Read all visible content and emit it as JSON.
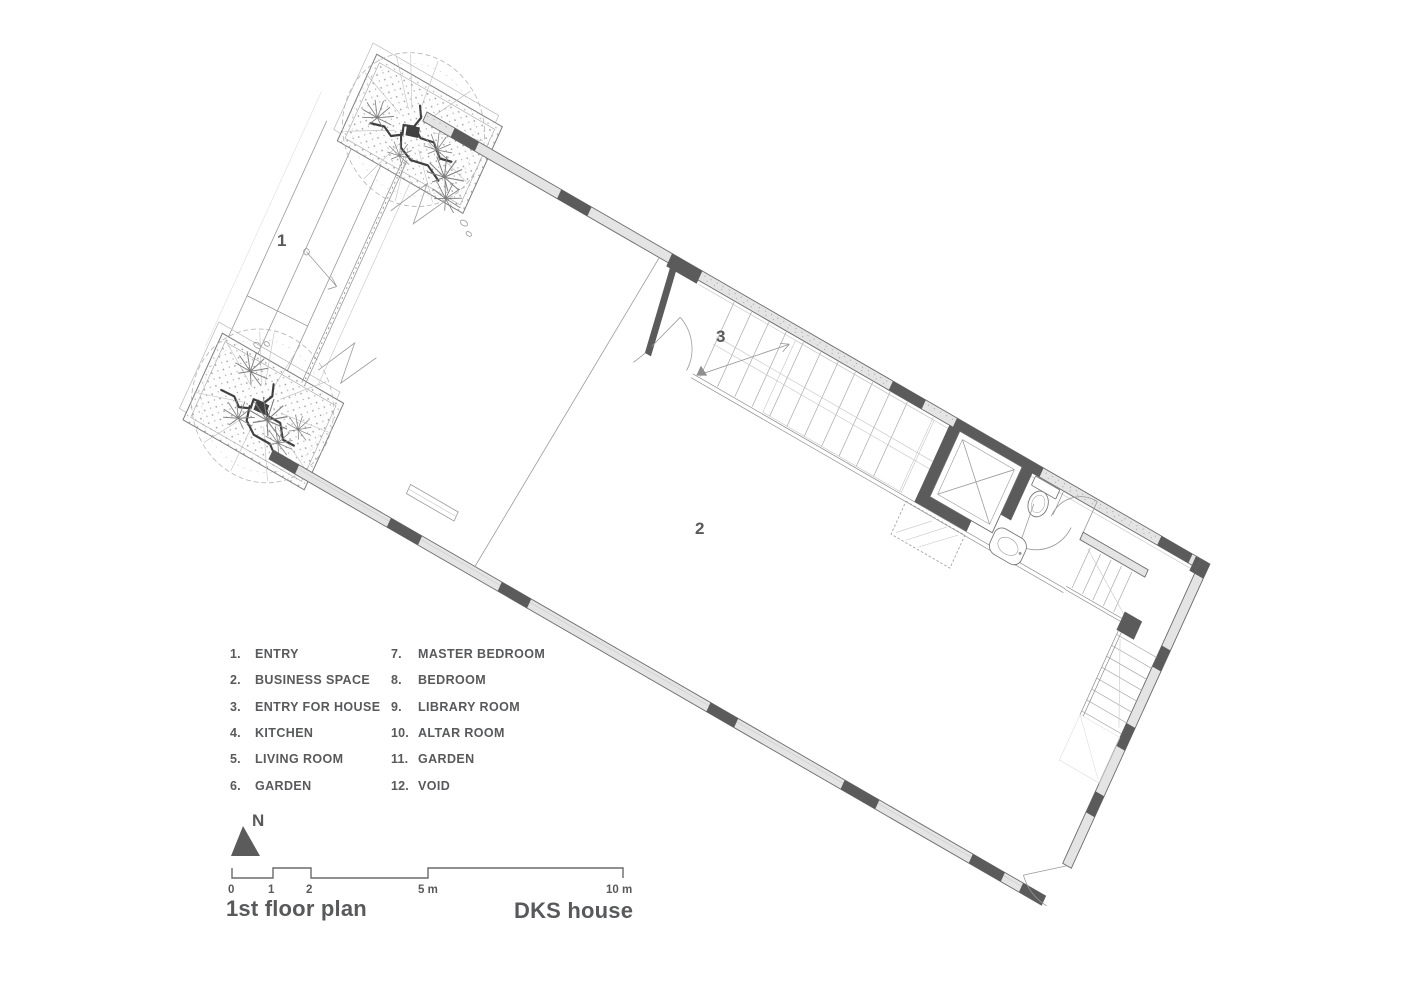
{
  "titles": {
    "plan_title": "1st floor plan",
    "project_title": "DKS house"
  },
  "compass": {
    "label": "N"
  },
  "scale_bar": {
    "labels": [
      "0",
      "1",
      "2",
      "5 m",
      "10 m"
    ]
  },
  "plan": {
    "room_markers": [
      "1",
      "2",
      "3"
    ]
  },
  "legend": {
    "col1": [
      {
        "n": "1.",
        "label": "ENTRY"
      },
      {
        "n": "2.",
        "label": "BUSINESS SPACE"
      },
      {
        "n": "3.",
        "label": "ENTRY FOR HOUSE"
      },
      {
        "n": "4.",
        "label": "KITCHEN"
      },
      {
        "n": "5.",
        "label": "LIVING ROOM"
      },
      {
        "n": "6.",
        "label": "GARDEN"
      }
    ],
    "col2": [
      {
        "n": "7.",
        "label": "MASTER BEDROOM"
      },
      {
        "n": "8.",
        "label": "BEDROOM"
      },
      {
        "n": "9.",
        "label": "LIBRARY ROOM"
      },
      {
        "n": "10.",
        "label": "ALTAR ROOM"
      },
      {
        "n": "11.",
        "label": "GARDEN"
      },
      {
        "n": "12.",
        "label": "VOID"
      }
    ]
  },
  "colors": {
    "wall_fill": "#e4e4e4",
    "wall_dark": "#5b5b5b",
    "line_gray": "#9a9a9a",
    "text_gray": "#58595b"
  }
}
